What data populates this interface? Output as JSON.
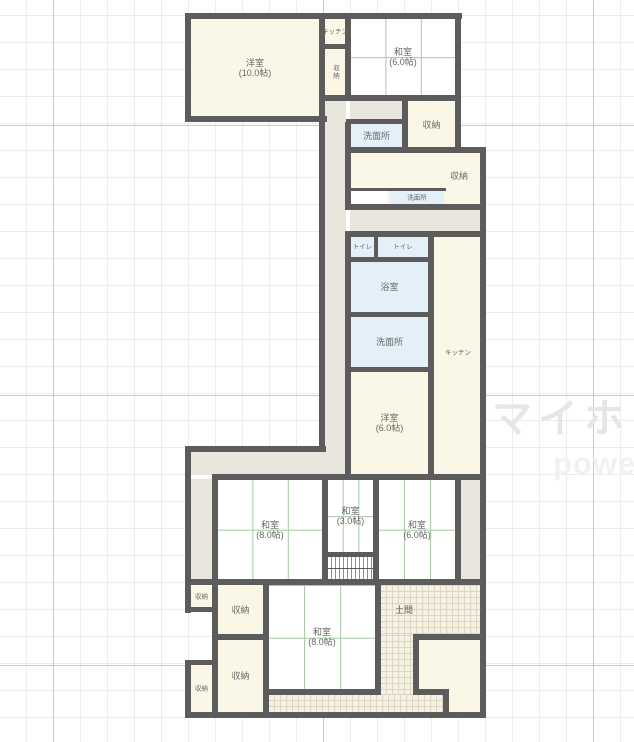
{
  "watermark": {
    "line1": "マイホ",
    "line2": "power"
  },
  "plan": {
    "wall_color": "#5c5c5c",
    "tatami_line_color": "#a3cba3",
    "room_fill_cream": "#fbf7e6",
    "hall_fill": "#e9e6dd",
    "wet_fill": "#e3f0f8",
    "rooms": [
      {
        "name": "yoshitsu-10",
        "label": "洋室",
        "label2": "(10.0帖)",
        "kind": "cream",
        "rect": [
          190,
          18,
          130,
          99
        ]
      },
      {
        "name": "kitchen-top",
        "label": "キッチン",
        "label2": "",
        "kind": "cream",
        "rect": [
          324,
          18,
          22,
          27
        ],
        "tiny": true
      },
      {
        "name": "closet-top",
        "label": "収納",
        "label2": "",
        "kind": "cream",
        "rect": [
          324,
          48,
          22,
          48
        ],
        "tiny": true,
        "vertical": true
      },
      {
        "name": "washitsu-6-top",
        "label": "和室",
        "label2": "(6.0帖)",
        "kind": "tatami",
        "rect": [
          350,
          18,
          106,
          78
        ]
      },
      {
        "name": "hall-a",
        "label": "",
        "label2": "",
        "kind": "hall",
        "rect": [
          324,
          100,
          22,
          375
        ]
      },
      {
        "name": "hall-b",
        "label": "",
        "label2": "",
        "kind": "hall",
        "rect": [
          350,
          100,
          53,
          20
        ]
      },
      {
        "name": "senmenjo-1",
        "label": "洗面所",
        "label2": "",
        "kind": "wet",
        "rect": [
          350,
          123,
          53,
          25
        ]
      },
      {
        "name": "closet-upper-right",
        "label": "収納",
        "label2": "",
        "kind": "cream",
        "rect": [
          407,
          102,
          49,
          46
        ]
      },
      {
        "name": "closet-wide",
        "label": "収納",
        "label2": "",
        "kind": "cream",
        "rect": [
          350,
          152,
          131,
          53
        ],
        "labelAt": [
          459,
          176
        ]
      },
      {
        "name": "hall-nook",
        "label": "",
        "label2": "",
        "kind": "plain",
        "rect": [
          350,
          190,
          37,
          15
        ]
      },
      {
        "name": "senmenjo-2",
        "label": "洗面所",
        "label2": "",
        "kind": "wet",
        "rect": [
          390,
          190,
          54,
          15
        ],
        "tiny": true
      },
      {
        "name": "hall-c",
        "label": "",
        "label2": "",
        "kind": "hall",
        "rect": [
          350,
          210,
          131,
          22
        ]
      },
      {
        "name": "toilet-1",
        "label": "トイレ",
        "label2": "",
        "kind": "wet",
        "rect": [
          350,
          236,
          25,
          22
        ],
        "tiny": true
      },
      {
        "name": "toilet-2",
        "label": "トイレ",
        "label2": "",
        "kind": "wet",
        "rect": [
          377,
          236,
          52,
          22
        ],
        "tiny": true
      },
      {
        "name": "bathroom",
        "label": "浴室",
        "label2": "",
        "kind": "wet",
        "rect": [
          350,
          261,
          79,
          52
        ]
      },
      {
        "name": "senmenjo-3",
        "label": "洗面所",
        "label2": "",
        "kind": "wet",
        "rect": [
          350,
          316,
          79,
          52
        ]
      },
      {
        "name": "yoshitsu-6",
        "label": "洋室",
        "label2": "(6.0帖)",
        "kind": "cream",
        "rect": [
          350,
          371,
          79,
          104
        ]
      },
      {
        "name": "kitchen-strip",
        "label": "キッチン",
        "label2": "",
        "kind": "cream",
        "rect": [
          433,
          236,
          48,
          239
        ],
        "tiny": true,
        "labelAt": [
          458,
          353
        ]
      },
      {
        "name": "hall-d",
        "label": "",
        "label2": "",
        "kind": "hall",
        "rect": [
          190,
          451,
          157,
          24
        ]
      },
      {
        "name": "hall-e",
        "label": "",
        "label2": "",
        "kind": "hall",
        "rect": [
          190,
          479,
          23,
          101
        ]
      },
      {
        "name": "washitsu-8-upper",
        "label": "和室",
        "label2": "(8.0帖)",
        "kind": "tatami",
        "rect": [
          217,
          479,
          106,
          101
        ]
      },
      {
        "name": "washitsu-3",
        "label": "和室",
        "label2": "(3.0帖)",
        "kind": "tatami",
        "rect": [
          327,
          479,
          47,
          74
        ]
      },
      {
        "name": "stairs",
        "label": "",
        "label2": "",
        "kind": "stairs",
        "rect": [
          327,
          556,
          47,
          24
        ]
      },
      {
        "name": "washitsu-6-mid",
        "label": "和室",
        "label2": "(6.0帖)",
        "kind": "tatami",
        "rect": [
          378,
          479,
          78,
          101
        ]
      },
      {
        "name": "hall-f",
        "label": "",
        "label2": "",
        "kind": "hall",
        "rect": [
          460,
          479,
          21,
          101
        ]
      },
      {
        "name": "closet-small-1",
        "label": "収納",
        "label2": "",
        "kind": "cream",
        "rect": [
          190,
          586,
          23,
          22
        ],
        "tiny": true
      },
      {
        "name": "closet-mid-1",
        "label": "収納",
        "label2": "",
        "kind": "cream",
        "rect": [
          217,
          585,
          47,
          50
        ]
      },
      {
        "name": "closet-small-2",
        "label": "収納",
        "label2": "",
        "kind": "cream",
        "rect": [
          190,
          665,
          23,
          48
        ],
        "tiny": true
      },
      {
        "name": "closet-mid-2",
        "label": "収納",
        "label2": "",
        "kind": "cream",
        "rect": [
          217,
          639,
          47,
          74
        ]
      },
      {
        "name": "washitsu-8-lower",
        "label": "和室",
        "label2": "(8.0帖)",
        "kind": "tatami",
        "rect": [
          268,
          585,
          108,
          105
        ],
        "labelAt": [
          322,
          637
        ]
      },
      {
        "name": "doma-1",
        "label": "土間",
        "label2": "",
        "kind": "doma",
        "rect": [
          380,
          585,
          101,
          50
        ],
        "labelAt": [
          404,
          610
        ]
      },
      {
        "name": "doma-2",
        "label": "",
        "label2": "",
        "kind": "doma",
        "rect": [
          380,
          635,
          34,
          60
        ]
      },
      {
        "name": "doma-3",
        "label": "",
        "label2": "",
        "kind": "doma",
        "rect": [
          268,
          694,
          176,
          19
        ]
      },
      {
        "name": "genkan-1",
        "label": "",
        "label2": "",
        "kind": "cream",
        "rect": [
          418,
          639,
          62,
          51
        ]
      },
      {
        "name": "genkan-2",
        "label": "",
        "label2": "",
        "kind": "cream",
        "rect": [
          448,
          639,
          33,
          74
        ]
      }
    ]
  }
}
